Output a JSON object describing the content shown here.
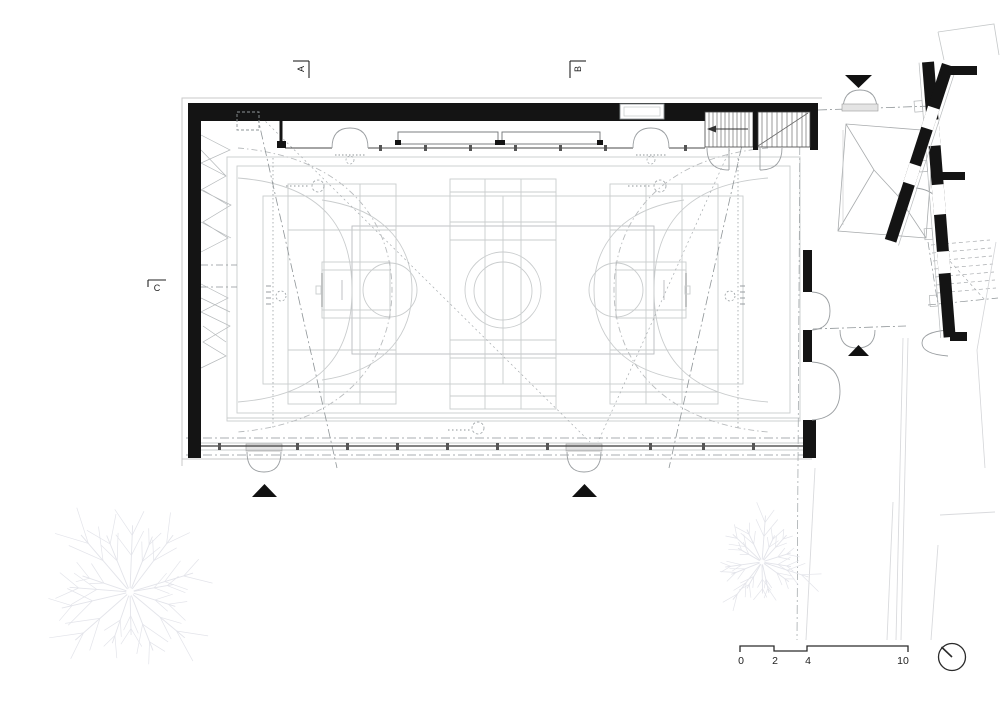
{
  "drawing": {
    "type": "architectural-floor-plan",
    "subject": "sports-hall-triple-court-ground-floor",
    "section_markers": {
      "a": "A",
      "b": "B",
      "c": "C"
    },
    "scale_bar": {
      "tick_labels": [
        "0",
        "2",
        "4",
        "10"
      ]
    },
    "colors": {
      "wall": "#141414",
      "court_line": "#c9cccd",
      "medium_line": "#9aa0a3",
      "door_line": "#9b9fa2",
      "glazing": "#3a3a3a",
      "tree_line": "#e3e4ea",
      "site_line": "#d9dadd"
    }
  },
  "site": {
    "trees": [
      {
        "cx": 130,
        "cy": 592,
        "r": 77
      },
      {
        "cx": 762,
        "cy": 562,
        "r": 50
      }
    ]
  }
}
